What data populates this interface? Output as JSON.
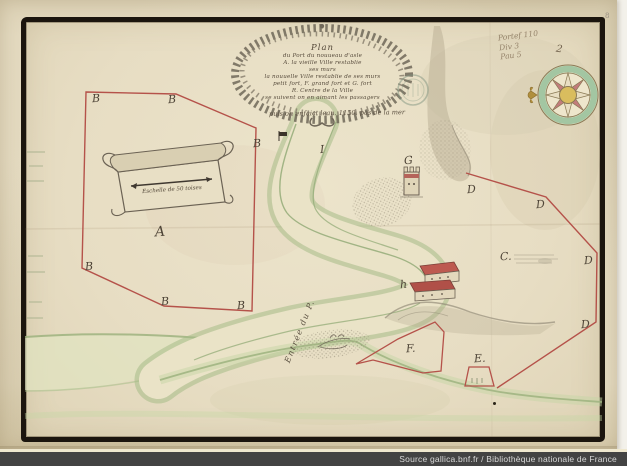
{
  "source_bar": {
    "text": "Source gallica.bnf.fr / Bibliothèque nationale de France"
  },
  "shelfmark": {
    "lines": [
      "Portef 110",
      "Div 3",
      "Pau 5"
    ],
    "number": "2",
    "corner_mark": "8"
  },
  "cartouche": {
    "title_lines": [
      "Plan",
      "du Port du nouueau d'asle",
      "A. la vieille Ville restablie",
      "ses murs",
      "la nouuelle Ville restablie de ses murs",
      "petit fort, F. grand fort et G. fort",
      "R. Centre de la Ville",
      "se suivent on en aimant les passagers"
    ],
    "subtitle": "puis on enfaict leau. 1150. pas de la mer"
  },
  "scale": {
    "label": "Eschelle de 50 toises"
  },
  "river": {
    "label": "Entrée du P."
  },
  "letters": [
    {
      "char": "B",
      "x": 92,
      "y": 92
    },
    {
      "char": "B",
      "x": 168,
      "y": 93
    },
    {
      "char": "B",
      "x": 253,
      "y": 137
    },
    {
      "char": "A",
      "x": 155,
      "y": 224,
      "big": true
    },
    {
      "char": "B",
      "x": 85,
      "y": 260
    },
    {
      "char": "B",
      "x": 161,
      "y": 295
    },
    {
      "char": "B",
      "x": 237,
      "y": 299
    },
    {
      "char": "D",
      "x": 467,
      "y": 183
    },
    {
      "char": "D",
      "x": 536,
      "y": 198
    },
    {
      "char": "D",
      "x": 584,
      "y": 254
    },
    {
      "char": "D",
      "x": 581,
      "y": 318
    },
    {
      "char": "C.",
      "x": 500,
      "y": 250
    },
    {
      "char": "G",
      "x": 404,
      "y": 154
    },
    {
      "char": "h",
      "x": 400,
      "y": 278
    },
    {
      "char": "F.",
      "x": 406,
      "y": 342
    },
    {
      "char": "E.",
      "x": 474,
      "y": 352
    },
    {
      "char": "I",
      "x": 320,
      "y": 143
    }
  ],
  "colors": {
    "paper": "#e3d9bf",
    "frame_ink": "#1b150e",
    "survey_red": "#b5524a",
    "shore_green": "#9db37f",
    "wash_green": "#c6d6a6",
    "compass_ring_green": "#a3c6a2",
    "compass_point_pink": "#c27c7c",
    "compass_center_gold": "#d9bd5e",
    "bar_background": "#434343"
  }
}
